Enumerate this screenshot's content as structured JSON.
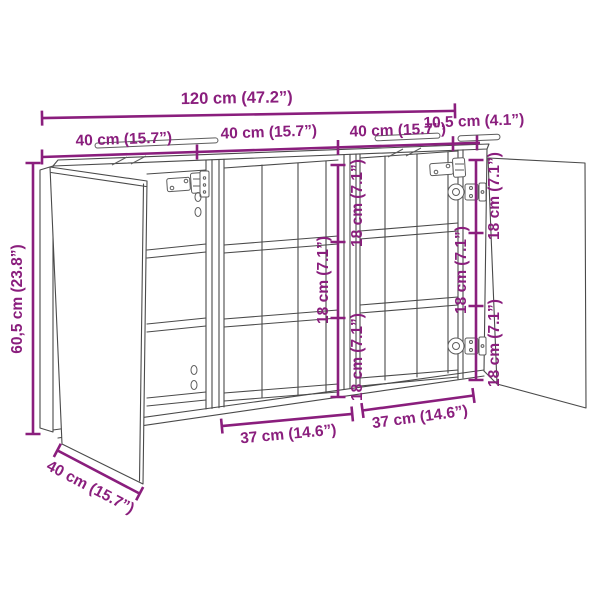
{
  "diagram": {
    "title": "sideboard-dimension-diagram",
    "type": "furniture dimension line drawing with open doors and shelves",
    "colors": {
      "dimension_accent": "#8a1e7d",
      "outline": "#4a4a4a",
      "background": "#ffffff"
    },
    "labels": {
      "overall_width": "120 cm (47.2”)",
      "section_width_left": "40 cm (15.7”)",
      "section_width_middle": "40 cm (15.7”)",
      "section_width_right": "40 cm (15.7”)",
      "top_overhang": "10,5 cm (4.1”)",
      "height": "60,5 cm (23.8”)",
      "depth": "40 cm (15.7”)",
      "gap_middle_top": "18 cm (7.1”)",
      "gap_middle_center": "18 cm (7.1”)",
      "gap_middle_bottom": "18 cm (7.1”)",
      "gap_right_top": "18 cm (7.1”)",
      "gap_right_center": "18 cm (7.1”)",
      "gap_right_bottom": "18 cm (7.1”)",
      "inner_width_middle": "37 cm (14.6”)",
      "inner_width_right": "37 cm (14.6”)"
    }
  }
}
